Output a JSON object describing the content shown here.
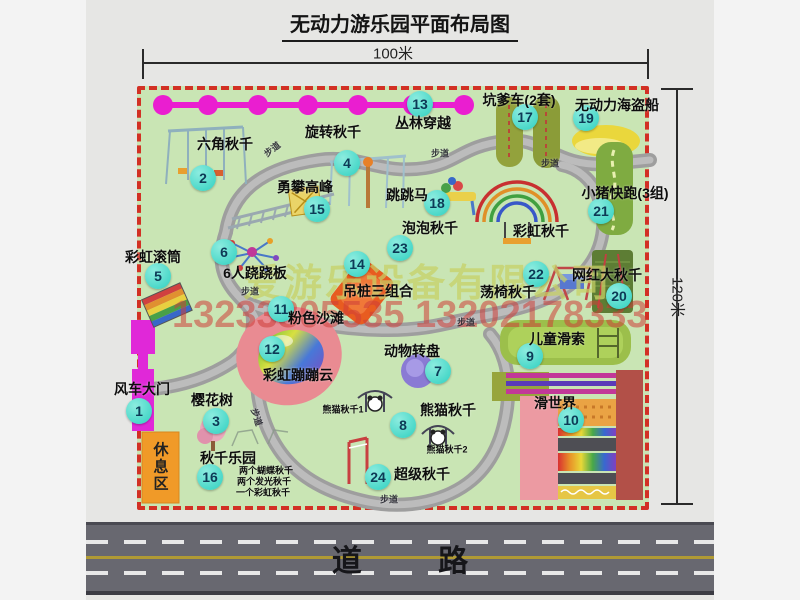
{
  "title": "无动力游乐园平面布局图",
  "dimensions": {
    "width_label": "100米",
    "height_label": "120米"
  },
  "road_label": "道 路",
  "rest_area_label": "休息区",
  "path_label": "步道",
  "rainbow_swing_label": "彩虹秋千",
  "watermark": {
    "company": "爱游乐设备有限公司",
    "phone": "13233805535 13202178333"
  },
  "swing_park_lines": [
    "两个蝴蝶秋千",
    "两个发光秋千",
    "一个彩虹秋千"
  ],
  "panda_labels": [
    "熊猫秋千1",
    "熊猫秋千2"
  ],
  "colors": {
    "boundary": "#d23024",
    "badge": "#2fd0c0",
    "jungle_line": "#ea1ed0",
    "map_bg": "#c9e5b4",
    "road_bg": "#686870"
  },
  "attractions": [
    {
      "num": "1",
      "name": "风车大门"
    },
    {
      "num": "2",
      "name": "六角秋千"
    },
    {
      "num": "3",
      "name": "樱花树"
    },
    {
      "num": "4",
      "name": "旋转秋千"
    },
    {
      "num": "5",
      "name": "彩虹滚筒"
    },
    {
      "num": "6",
      "name": "6人跷跷板"
    },
    {
      "num": "7",
      "name": "动物转盘"
    },
    {
      "num": "8",
      "name": "熊猫秋千"
    },
    {
      "num": "9",
      "name": "儿童滑索"
    },
    {
      "num": "10",
      "name": "滑世界"
    },
    {
      "num": "11",
      "name": "粉色沙滩"
    },
    {
      "num": "12",
      "name": "彩虹蹦蹦云"
    },
    {
      "num": "13",
      "name": "丛林穿越"
    },
    {
      "num": "14",
      "name": "吊桩三组合"
    },
    {
      "num": "15",
      "name": "勇攀高峰"
    },
    {
      "num": "16",
      "name": "秋千乐园"
    },
    {
      "num": "17",
      "name": "坑爹车(2套)"
    },
    {
      "num": "18",
      "name": "跳跳马"
    },
    {
      "num": "19",
      "name": "无动力海盗船"
    },
    {
      "num": "20",
      "name": "网红大秋千"
    },
    {
      "num": "21",
      "name": "小猪快跑(3组)"
    },
    {
      "num": "22",
      "name": "荡椅秋千"
    },
    {
      "num": "23",
      "name": "泡泡秋千"
    },
    {
      "num": "24",
      "name": "超级秋千"
    }
  ]
}
